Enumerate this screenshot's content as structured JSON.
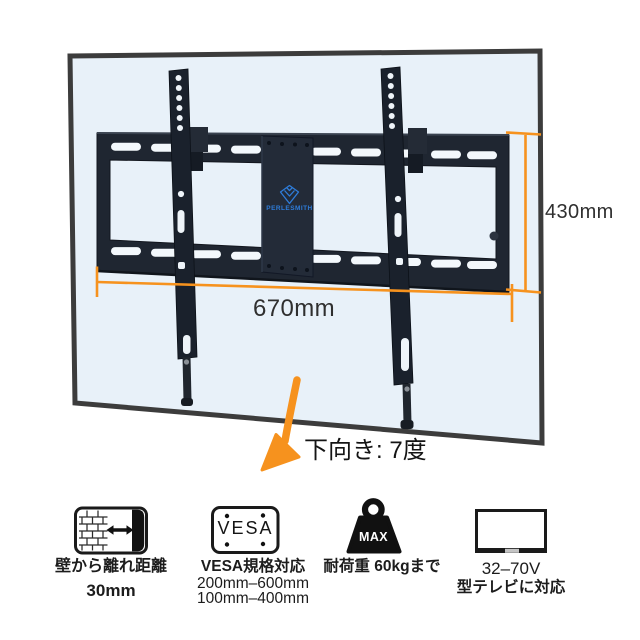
{
  "product": {
    "brand_logo_text": "PERLESMITH",
    "dimensions": {
      "height_label": "430mm",
      "width_label": "670mm"
    },
    "tilt_label": "下向き: 7度",
    "features": [
      {
        "id": "wall-distance",
        "icon": "brick-wall-tv-gap-icon",
        "caption_lines": [
          "壁から離れ距離",
          "30mm"
        ]
      },
      {
        "id": "vesa",
        "icon": "vesa-plate-icon",
        "icon_label": "VESA",
        "caption_lines": [
          "VESA規格対応",
          "200mm–600mm",
          "100mm–400mm"
        ]
      },
      {
        "id": "max-load",
        "icon": "weight-icon",
        "icon_label": "MAX",
        "caption_lines": [
          "耐荷重 60kgまで"
        ]
      },
      {
        "id": "tv-size",
        "icon": "tv-screen-icon",
        "caption_lines": [
          "32–70V",
          "型テレビに対応"
        ]
      }
    ],
    "colors": {
      "accent_orange": "#f6921e",
      "mount_black": "#1f2631",
      "panel_fill": "#e8f1f9",
      "panel_border": "#3c3c3c",
      "logo_blue": "#2e7cd9",
      "icon_black": "#141414"
    }
  }
}
